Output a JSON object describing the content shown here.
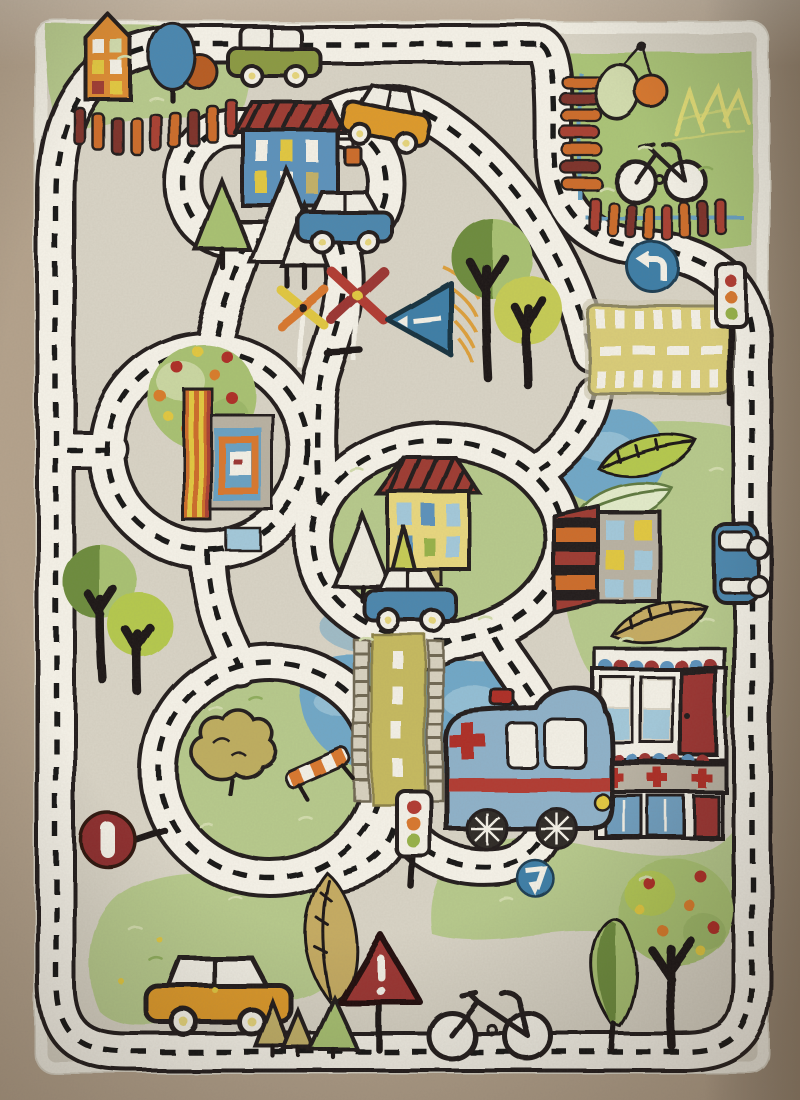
{
  "image": {
    "alt": "Top-down photograph of a children's city road play rug with roads, houses, cars, trees, a pond with a bridge, a hospital, an ambulance and traffic signs on a beige background",
    "width": 800,
    "height": 1100
  },
  "palette": {
    "rug_border": "#b4a28c",
    "rug_border_dark": "#8a7b67",
    "rug_border_light": "#cbbca6",
    "field": "#d9d4c6",
    "border_white": "#f1eee3",
    "outline": "#211e1b",
    "trunk": "#1b1917",
    "road_white": "#f6f3e9",
    "road_line": "#171513",
    "grass": "#b7ca8c",
    "grass_light": "#d3ddae",
    "park_green": "#abc577",
    "green_dark": "#8fae5c",
    "pond": "#70a8c8",
    "pond_light": "#a3c9db",
    "house_orange": "#dc8b30",
    "house_blue": "#5b92bc",
    "house_yellow": "#e9d87f",
    "wall_gray": "#b9b2a3",
    "roof_red": "#9e3a31",
    "car_olive": "#8b9a43",
    "car_orange": "#de9a2b",
    "car_blue": "#4c87ae",
    "car_body_white": "#f2efe5",
    "ambulance_blue": "#8fb2ca",
    "fence_orange": "#cd6c2a",
    "fence_red": "#a93f33",
    "fence_dark": "#7e332a",
    "rail_blue": "#69a1c3",
    "sign_blue": "#3e7ea7",
    "sign_red": "#9c3430",
    "stop_red": "#8e2f2e",
    "bridge_olive": "#c6ba5e",
    "bridge_rail": "#d8d2c0",
    "bridge_rail_dark": "#6f6753",
    "crosswalk_yellow": "#dacd78",
    "tree_green": "#a9c272",
    "tree_dark": "#6d8c3e",
    "tree_yellow": "#c6cc55",
    "tree_lime": "#b5c94e",
    "tree_khaki": "#c3b167",
    "tan_leaf": "#c6ac62",
    "cloud_olive": "#bfae5e",
    "pine_white": "#efece0",
    "blue_tree": "#4a87b0",
    "orange_tree": "#b85c20",
    "light_red": "#b23a32",
    "light_orange": "#d9782d",
    "light_green": "#97b24a",
    "fruit_red": "#ae2f27",
    "fruit_orange": "#d97b2c",
    "fruit_yellow": "#e2c83f",
    "wheel_dark": "#2e2b28",
    "hub_yellow": "#e7d67c",
    "white": "#f4f1e7",
    "scribble_yellow": "#e3de77"
  },
  "scene": {
    "objects": [
      "perimeter road with dashed center line",
      "inner road loop around blue house",
      "roundabout with apple tree and car-wash kiosk",
      "green island with yellow house, pines and blue car",
      "top-right fenced park with balloon trees, crayon scribble and bicycle",
      "yellow crosswalk road segment",
      "pond with olive wooden bridge and ladder railings",
      "hospital building with red crosses and blue doors",
      "blue ambulance with red cross and beacon",
      "orange house on grass with picket fence",
      "blue house with striped red roof and lamp",
      "white-green car, yellow car, blue cars, orange car",
      "two traffic lights",
      "blue round turn signs",
      "blue triangle sign with orange scribble",
      "two pinwheels",
      "red warning triangle with exclamation mark",
      "do-not-enter style red sign",
      "orange and white striped barrier",
      "bicycles, apple trees, leaf trees, pines, feather leaves, cloud bush"
    ]
  }
}
